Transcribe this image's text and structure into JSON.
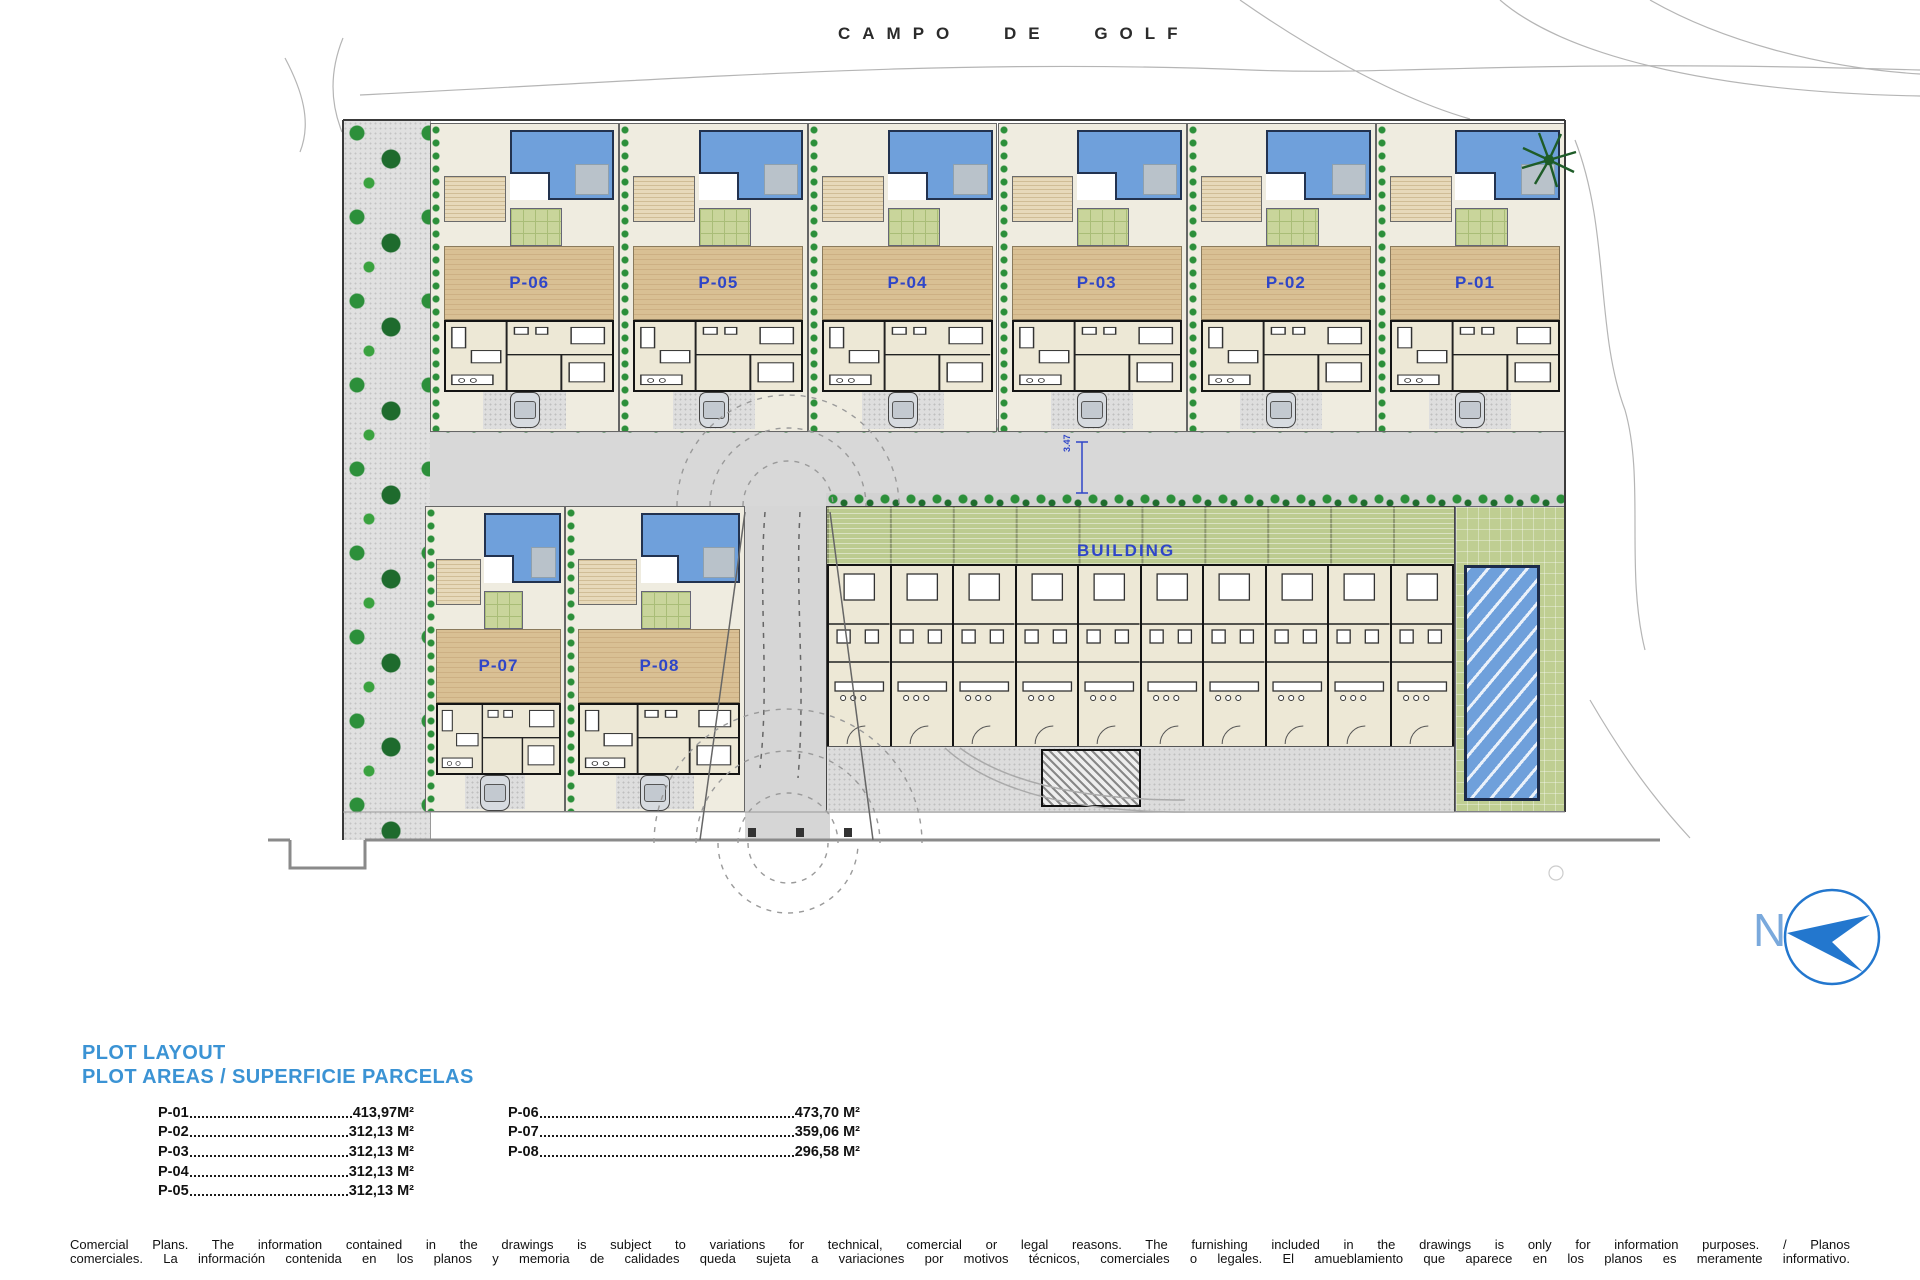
{
  "title": "CAMPO DE GOLF",
  "compass": {
    "label": "N"
  },
  "plan": {
    "top_plots": [
      {
        "id": "P-06"
      },
      {
        "id": "P-05"
      },
      {
        "id": "P-04"
      },
      {
        "id": "P-03"
      },
      {
        "id": "P-02"
      },
      {
        "id": "P-01"
      }
    ],
    "bottom_plots": [
      {
        "id": "P-07"
      },
      {
        "id": "P-08"
      }
    ],
    "building_label": "BUILDING",
    "road_dimension": "3.47"
  },
  "legend": {
    "heading_line1": "PLOT LAYOUT",
    "heading_line2": "PLOT AREAS / SUPERFICIE PARCELAS",
    "column1": [
      {
        "plot": "P-01",
        "area": "413,97M²"
      },
      {
        "plot": "P-02",
        "area": "312,13 M²"
      },
      {
        "plot": "P-03",
        "area": "312,13 M²"
      },
      {
        "plot": "P-04",
        "area": "312,13 M²"
      },
      {
        "plot": "P-05",
        "area": "312,13 M²"
      }
    ],
    "column2": [
      {
        "plot": "P-06",
        "area": "473,70 M²"
      },
      {
        "plot": "P-07",
        "area": "359,06 M²"
      },
      {
        "plot": "P-08",
        "area": "296,58 M²"
      }
    ]
  },
  "disclaimer": {
    "line1": "Comercial Plans. The information contained in the drawings is subject to variations for technical, comercial or legal reasons. The furnishing included in the drawings is only for information purposes. / Planos",
    "line2": "comerciales. La información contenida en los planos y memoria de calidades queda sujeta a variaciones por motivos técnicos, comerciales o legales. El amueblamiento que aparece en los planos es meramente informativo."
  },
  "colors": {
    "plot_label_blue": "#2f46c8",
    "heading_blue": "#3b93d4",
    "pool_blue": "#6fa0db",
    "compass_blue": "#2377ce"
  }
}
